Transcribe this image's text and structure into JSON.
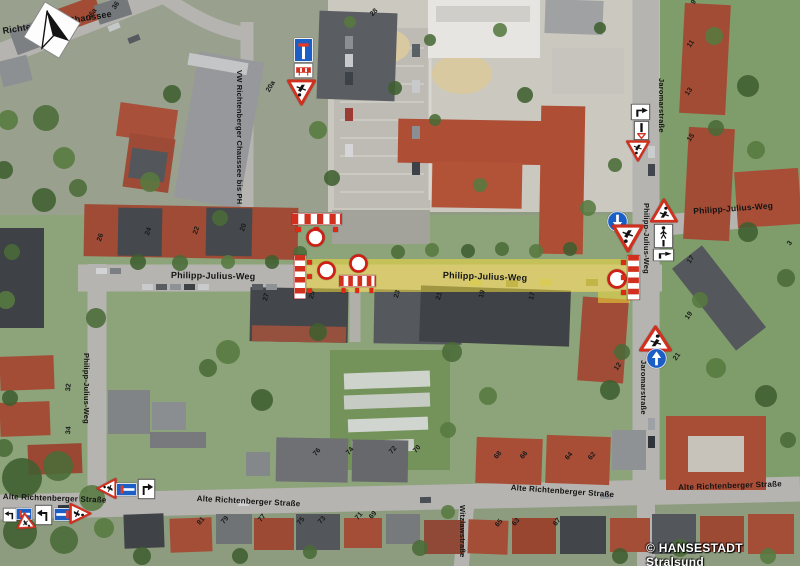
{
  "meta": {
    "copyright": "© HANSESTADT Stralsund"
  },
  "colors": {
    "route_highlight": "#f0db3c",
    "barrier_red": "#d2301f",
    "sign_blue": "#1b5fc6",
    "label": "#141414"
  },
  "street_labels": [
    {
      "text": "Richtenberger Chaussee",
      "x": 2,
      "y": 27,
      "rot": -9,
      "size": 9
    },
    {
      "text": "VW Richtenberger Chaussee bis PH",
      "x": 243,
      "y": 70,
      "rot": 90,
      "size": 7.5
    },
    {
      "text": "Philipp-Julius-Weg",
      "x": 171,
      "y": 271,
      "rot": 1,
      "size": 9
    },
    {
      "text": "Philipp-Julius-Weg",
      "x": 443,
      "y": 271,
      "rot": 2,
      "size": 9
    },
    {
      "text": "Philipp-Julius-Weg",
      "x": 90,
      "y": 353,
      "rot": 90,
      "size": 7.5
    },
    {
      "text": "Philipp-Julius-Weg",
      "x": 650,
      "y": 203,
      "rot": 90,
      "size": 7.5
    },
    {
      "text": "Philipp-Julius-Weg",
      "x": 693,
      "y": 207,
      "rot": -4,
      "size": 8.5
    },
    {
      "text": "Jaromarstraße",
      "x": 665,
      "y": 78,
      "rot": 90,
      "size": 7.5
    },
    {
      "text": "Jaromarstraße",
      "x": 647,
      "y": 360,
      "rot": 90,
      "size": 7.5
    },
    {
      "text": "Alte Richtenberger Straße",
      "x": 3,
      "y": 493,
      "rot": 2,
      "size": 8
    },
    {
      "text": "Alte Richtenberger Straße",
      "x": 197,
      "y": 495,
      "rot": 3,
      "size": 8
    },
    {
      "text": "Alte Richtenberger Straße",
      "x": 511,
      "y": 484,
      "rot": 4,
      "size": 8
    },
    {
      "text": "Alte Richtenberger Straße",
      "x": 678,
      "y": 484,
      "rot": -2,
      "size": 8
    },
    {
      "text": "Witzlawstraße",
      "x": 466,
      "y": 505,
      "rot": 90,
      "size": 7.5
    }
  ],
  "house_numbers": [
    {
      "text": "40",
      "x": 45,
      "y": 39,
      "rot": -55
    },
    {
      "text": "38",
      "x": 62,
      "y": 37,
      "rot": -55
    },
    {
      "text": "36a",
      "x": 86,
      "y": 17,
      "rot": -55
    },
    {
      "text": "36",
      "x": 111,
      "y": 7,
      "rot": -55
    },
    {
      "text": "28",
      "x": 369,
      "y": 13,
      "rot": -45
    },
    {
      "text": "20a",
      "x": 265,
      "y": 90,
      "rot": -60
    },
    {
      "text": "26",
      "x": 96,
      "y": 240,
      "rot": -70
    },
    {
      "text": "24",
      "x": 144,
      "y": 234,
      "rot": -70
    },
    {
      "text": "22",
      "x": 192,
      "y": 233,
      "rot": -70
    },
    {
      "text": "20",
      "x": 239,
      "y": 230,
      "rot": -70
    },
    {
      "text": "9",
      "x": 690,
      "y": 2,
      "rot": -55
    },
    {
      "text": "11",
      "x": 686,
      "y": 45,
      "rot": -55
    },
    {
      "text": "13",
      "x": 684,
      "y": 93,
      "rot": -55
    },
    {
      "text": "15",
      "x": 686,
      "y": 139,
      "rot": -55
    },
    {
      "text": "17",
      "x": 686,
      "y": 261,
      "rot": -55
    },
    {
      "text": "19",
      "x": 684,
      "y": 317,
      "rot": -55
    },
    {
      "text": "21",
      "x": 672,
      "y": 358,
      "rot": -55
    },
    {
      "text": "3",
      "x": 786,
      "y": 243,
      "rot": -55
    },
    {
      "text": "27",
      "x": 262,
      "y": 300,
      "rot": -75
    },
    {
      "text": "25",
      "x": 308,
      "y": 298,
      "rot": -75
    },
    {
      "text": "23",
      "x": 393,
      "y": 297,
      "rot": -75
    },
    {
      "text": "21",
      "x": 435,
      "y": 299,
      "rot": -75
    },
    {
      "text": "19",
      "x": 478,
      "y": 297,
      "rot": -75
    },
    {
      "text": "17",
      "x": 528,
      "y": 299,
      "rot": -75
    },
    {
      "text": "76",
      "x": 312,
      "y": 453,
      "rot": -50
    },
    {
      "text": "74",
      "x": 345,
      "y": 452,
      "rot": -50
    },
    {
      "text": "72",
      "x": 388,
      "y": 451,
      "rot": -50
    },
    {
      "text": "70",
      "x": 412,
      "y": 450,
      "rot": -50
    },
    {
      "text": "68",
      "x": 493,
      "y": 456,
      "rot": -50
    },
    {
      "text": "66",
      "x": 519,
      "y": 456,
      "rot": -50
    },
    {
      "text": "64",
      "x": 564,
      "y": 457,
      "rot": -50
    },
    {
      "text": "62",
      "x": 587,
      "y": 457,
      "rot": -50
    },
    {
      "text": "81",
      "x": 196,
      "y": 522,
      "rot": -50
    },
    {
      "text": "79",
      "x": 220,
      "y": 521,
      "rot": -50
    },
    {
      "text": "77",
      "x": 257,
      "y": 519,
      "rot": -50
    },
    {
      "text": "75",
      "x": 296,
      "y": 522,
      "rot": -50
    },
    {
      "text": "73",
      "x": 317,
      "y": 521,
      "rot": -50
    },
    {
      "text": "71",
      "x": 354,
      "y": 517,
      "rot": -50
    },
    {
      "text": "69",
      "x": 368,
      "y": 516,
      "rot": -50
    },
    {
      "text": "65",
      "x": 494,
      "y": 524,
      "rot": -50
    },
    {
      "text": "63",
      "x": 511,
      "y": 523,
      "rot": -50
    },
    {
      "text": "67",
      "x": 552,
      "y": 523,
      "rot": -50
    },
    {
      "text": "32",
      "x": 65,
      "y": 391,
      "rot": -85
    },
    {
      "text": "34",
      "x": 65,
      "y": 434,
      "rot": -85
    },
    {
      "text": "12",
      "x": 613,
      "y": 368,
      "rot": -55
    }
  ],
  "signs": [
    {
      "icon": "dead-end-sign-icon",
      "type": "dead-end",
      "x": 294,
      "y": 38,
      "w": 19,
      "h": 24,
      "rot": 0
    },
    {
      "icon": "barrier-supplementary-sign-icon",
      "type": "barrier-panel",
      "x": 294,
      "y": 63,
      "w": 19,
      "h": 15,
      "rot": 0
    },
    {
      "icon": "roadworks-sign-icon",
      "type": "roadworks",
      "x": 287,
      "y": 79,
      "w": 29,
      "h": 27,
      "rot": 180
    },
    {
      "icon": "barrier-icon",
      "type": "barrier-h",
      "x": 292,
      "y": 213,
      "w": 50,
      "h": 12,
      "rot": 0
    },
    {
      "icon": "warning-lamps-icon",
      "type": "lamp-row",
      "x": 295,
      "y": 227,
      "w": 44,
      "h": 5,
      "rot": 0
    },
    {
      "icon": "no-vehicles-sign-icon",
      "type": "no-vehicles",
      "x": 306,
      "y": 228,
      "w": 19,
      "h": 19,
      "rot": 0
    },
    {
      "icon": "barrier-icon",
      "type": "barrier-v",
      "x": 294,
      "y": 255,
      "w": 12,
      "h": 44,
      "rot": 0
    },
    {
      "icon": "warning-lamps-icon",
      "type": "lamp-col",
      "x": 307,
      "y": 259,
      "w": 5,
      "h": 36,
      "rot": 0
    },
    {
      "icon": "no-vehicles-sign-icon",
      "type": "no-vehicles",
      "x": 317,
      "y": 261,
      "w": 19,
      "h": 19,
      "rot": 0
    },
    {
      "icon": "no-vehicles-sign-icon",
      "type": "no-vehicles",
      "x": 349,
      "y": 254,
      "w": 19,
      "h": 19,
      "rot": 0
    },
    {
      "icon": "barrier-icon",
      "type": "barrier-h",
      "x": 339,
      "y": 275,
      "w": 37,
      "h": 12,
      "rot": 0
    },
    {
      "icon": "warning-lamps-icon",
      "type": "lamp-row",
      "x": 341,
      "y": 288,
      "w": 33,
      "h": 5,
      "rot": 0
    },
    {
      "icon": "mandatory-direction-sign-icon",
      "type": "mandatory-arrow",
      "x": 607,
      "y": 211,
      "w": 21,
      "h": 21,
      "rot": 180
    },
    {
      "icon": "roadworks-sign-icon",
      "type": "roadworks",
      "x": 612,
      "y": 224,
      "w": 32,
      "h": 29,
      "rot": 180
    },
    {
      "icon": "no-vehicles-sign-icon",
      "type": "no-vehicles",
      "x": 607,
      "y": 269,
      "w": 20,
      "h": 20,
      "rot": 0
    },
    {
      "icon": "warning-lamps-icon",
      "type": "lamp-col",
      "x": 621,
      "y": 259,
      "w": 5,
      "h": 38,
      "rot": 0
    },
    {
      "icon": "barrier-icon",
      "type": "barrier-v",
      "x": 627,
      "y": 255,
      "w": 13,
      "h": 45,
      "rot": 0
    },
    {
      "icon": "roadworks-sign-icon",
      "type": "roadworks",
      "x": 650,
      "y": 198,
      "w": 28,
      "h": 25,
      "rot": 0
    },
    {
      "icon": "pedestrian-detour-sign-icon",
      "type": "ped-panel",
      "x": 654,
      "y": 224,
      "w": 19,
      "h": 24,
      "rot": 0
    },
    {
      "icon": "direction-arrow-panel-icon",
      "type": "arrow-panel",
      "x": 653,
      "y": 249,
      "w": 21,
      "h": 12,
      "rot": 0
    },
    {
      "icon": "direction-arrow-panel-icon",
      "type": "arrow-panel",
      "x": 631,
      "y": 104,
      "w": 19,
      "h": 16,
      "rot": 0
    },
    {
      "icon": "priority-bar-panel-icon",
      "type": "bar-panel",
      "x": 634,
      "y": 121,
      "w": 15,
      "h": 19,
      "rot": 0
    },
    {
      "icon": "roadworks-sign-icon",
      "type": "roadworks",
      "x": 626,
      "y": 140,
      "w": 24,
      "h": 22,
      "rot": 180
    },
    {
      "icon": "roadworks-sign-icon",
      "type": "roadworks",
      "x": 639,
      "y": 325,
      "w": 33,
      "h": 27,
      "rot": 0
    },
    {
      "icon": "mandatory-direction-sign-icon",
      "type": "mandatory-arrow",
      "x": 646,
      "y": 348,
      "w": 21,
      "h": 21,
      "rot": 0
    },
    {
      "icon": "roadworks-sign-icon",
      "type": "roadworks",
      "x": 96,
      "y": 478,
      "w": 21,
      "h": 21,
      "rot": -90
    },
    {
      "icon": "dead-end-sign-icon",
      "type": "dead-end-h",
      "x": 116,
      "y": 483,
      "w": 21,
      "h": 13,
      "rot": 0
    },
    {
      "icon": "direction-arrow-panel-icon",
      "type": "arrow-panel",
      "x": 138,
      "y": 479,
      "w": 17,
      "h": 20,
      "rot": 0
    },
    {
      "icon": "direction-arrow-panel-icon",
      "type": "arrow-panel",
      "x": 35,
      "y": 505,
      "w": 17,
      "h": 20,
      "rot": 0,
      "flip": true
    },
    {
      "icon": "dead-end-sign-icon",
      "type": "dead-end-h",
      "x": 54,
      "y": 508,
      "w": 19,
      "h": 13,
      "rot": 0,
      "flip": true
    },
    {
      "icon": "roadworks-sign-icon",
      "type": "roadworks",
      "x": 70,
      "y": 502,
      "w": 21,
      "h": 23,
      "rot": 90
    },
    {
      "icon": "direction-arrow-panel-icon",
      "type": "arrow-panel",
      "x": 3,
      "y": 508,
      "w": 14,
      "h": 14,
      "rot": 0,
      "flip": true
    },
    {
      "icon": "dead-end-sign-icon",
      "type": "dead-end-h",
      "x": 16,
      "y": 508,
      "w": 16,
      "h": 12,
      "rot": 0
    },
    {
      "icon": "roadworks-sign-icon",
      "type": "roadworks",
      "x": 19,
      "y": 515,
      "w": 18,
      "h": 18,
      "rot": 115
    }
  ]
}
